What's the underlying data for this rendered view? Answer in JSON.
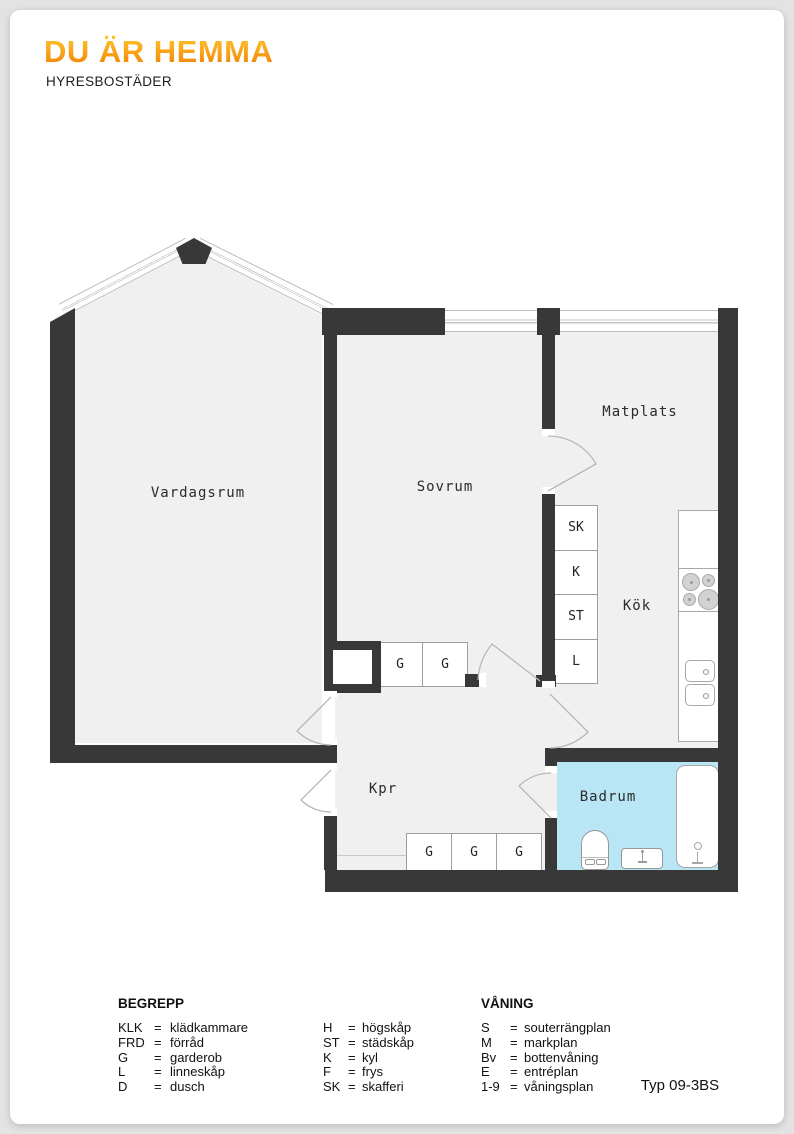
{
  "brand": {
    "title": "DU ÄR HEMMA",
    "subtitle": "HYRESBOSTÄDER"
  },
  "rooms": {
    "vardagsrum": "Vardagsrum",
    "sovrum": "Sovrum",
    "matplats": "Matplats",
    "kok": "Kök",
    "kpr": "Kpr",
    "badrum": "Badrum"
  },
  "closets": {
    "kitchen_column": [
      "SK",
      "K",
      "ST",
      "L"
    ],
    "sovrum_row": [
      "G",
      "G"
    ],
    "hall_row": [
      "G",
      "G",
      "G"
    ]
  },
  "legend": {
    "begrepp_title": "BEGREPP",
    "begrepp_col1": [
      {
        "abbr": "KLK",
        "eq": "=",
        "term": "klädkammare"
      },
      {
        "abbr": "FRD",
        "eq": "=",
        "term": "förråd"
      },
      {
        "abbr": "G",
        "eq": "=",
        "term": "garderob"
      },
      {
        "abbr": "L",
        "eq": "=",
        "term": "linneskåp"
      },
      {
        "abbr": "D",
        "eq": "=",
        "term": "dusch"
      }
    ],
    "begrepp_col2": [
      {
        "abbr": "H",
        "eq": "=",
        "term": "högskåp"
      },
      {
        "abbr": "ST",
        "eq": "=",
        "term": "städskåp"
      },
      {
        "abbr": "K",
        "eq": "=",
        "term": "kyl"
      },
      {
        "abbr": "F",
        "eq": "=",
        "term": "frys"
      },
      {
        "abbr": "SK",
        "eq": "=",
        "term": "skafferi"
      }
    ],
    "vaning_title": "VÅNING",
    "vaning_col": [
      {
        "abbr": "S",
        "eq": "=",
        "term": "souterrängplan"
      },
      {
        "abbr": "M",
        "eq": "=",
        "term": "markplan"
      },
      {
        "abbr": "Bv",
        "eq": "=",
        "term": "bottenvåning"
      },
      {
        "abbr": "E",
        "eq": "=",
        "term": "entréplan"
      },
      {
        "abbr": "1-9",
        "eq": "=",
        "term": "våningsplan"
      }
    ]
  },
  "plan_type": "Typ 09-3BS",
  "colors": {
    "accent_orange": "#F59100",
    "wall": "#383838",
    "room_fill": "#F0F0F0",
    "bathroom_fill": "#B9E6F5"
  }
}
